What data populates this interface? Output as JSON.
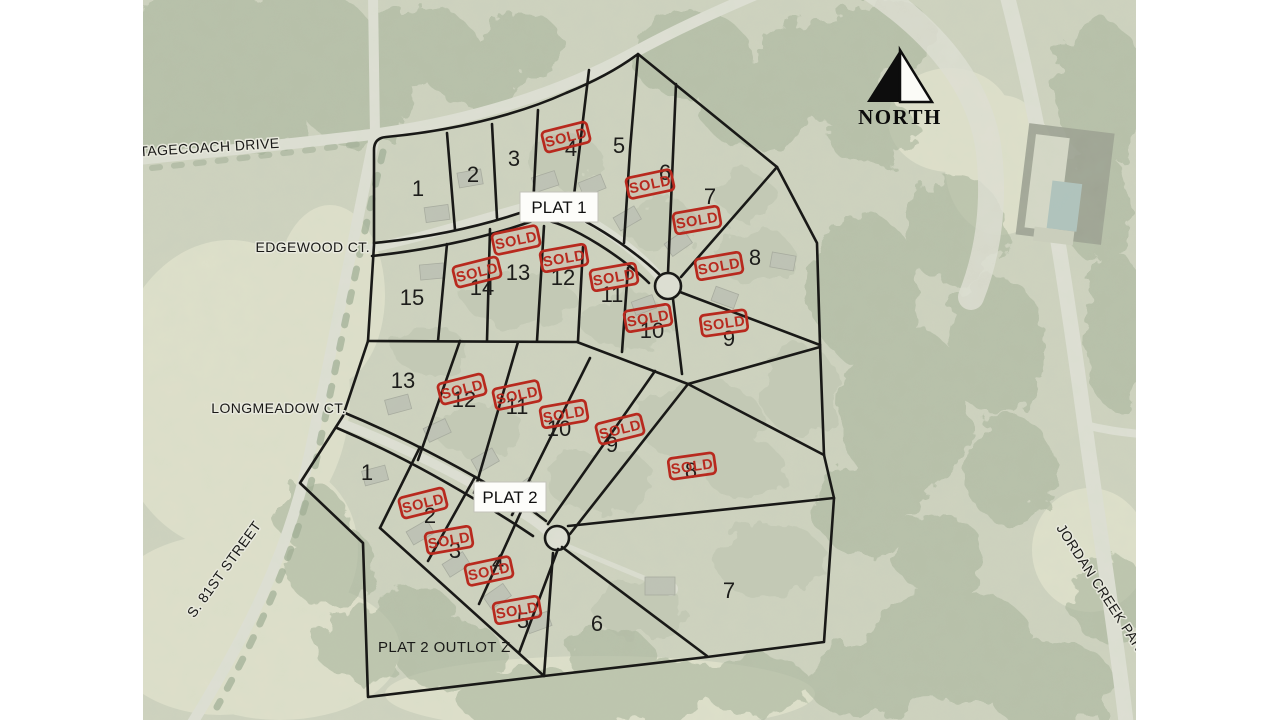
{
  "north_label": "NORTH",
  "sold_label": "SOLD",
  "plat1": {
    "label": "PLAT 1",
    "lots": [
      "1",
      "2",
      "3",
      "4",
      "5",
      "6",
      "7",
      "8",
      "9",
      "10",
      "11",
      "12",
      "13",
      "14",
      "15"
    ]
  },
  "plat2": {
    "label": "PLAT 2",
    "outlot_label": "PLAT 2 OUTLOT Z",
    "lots": [
      "1",
      "2",
      "3",
      "4",
      "5",
      "6",
      "7",
      "8",
      "9",
      "10",
      "11",
      "12",
      "13"
    ]
  },
  "streets": {
    "stagecoach": "STAGECOACH DRIVE",
    "edgewood": "EDGEWOOD CT.",
    "longmeadow": "LONGMEADOW CT.",
    "s81st": "S. 81ST STREET",
    "jordan": "JORDAN CREEK PARWAY"
  },
  "colors": {
    "sold_red": "#b8291e",
    "plat_line": "#191917",
    "aerial_base": "#c7ccb6"
  }
}
